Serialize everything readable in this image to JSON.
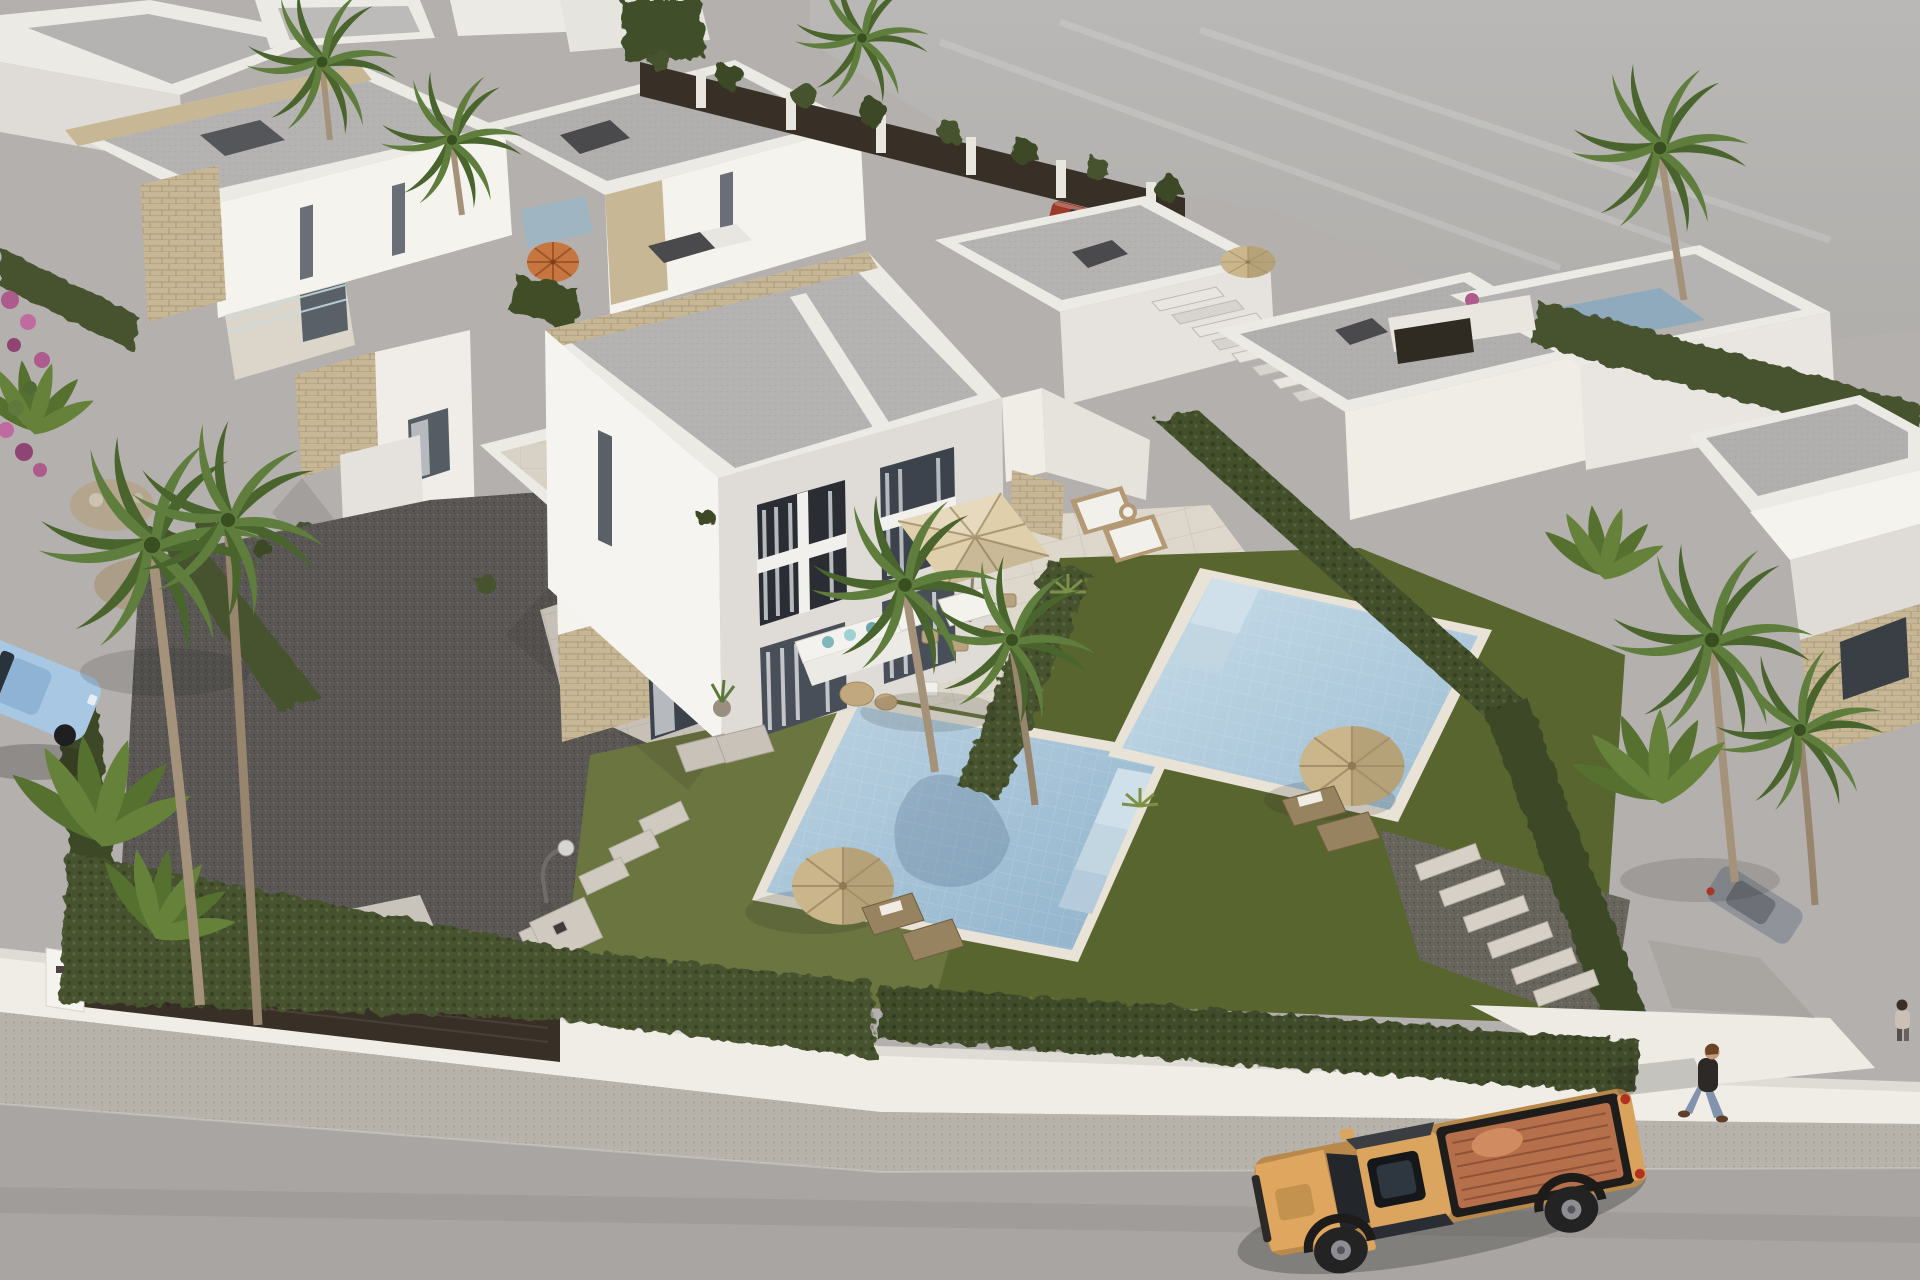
{
  "meta": {
    "kind": "photorealistic 3D architectural visualization",
    "view": "aerial oblique, sunlight from upper right",
    "width_px": 1920,
    "height_px": 1280
  },
  "scene": {
    "description": "Aerial render of a modern residential development: a central semi-detached two-storey white villa with stone-clad accents, two private pools with lawns, gravel yard, straw and beige parasols, loungers, palm trees and clipped hedges behind a white perimeter wall; an asphalt street with an orange pickup truck and a pedestrian runs along the bottom; background rows of flat-roof villas and an empty graded plot at upper right.",
    "objects": [
      "semi-detached two-storey villa (center)",
      "background white villas with flat roofs",
      "external roof stairs on background villas",
      "rooftop chimney boxes",
      "stone-clad facade accents",
      "glass balustrades",
      "two private swimming pools with underwater steps",
      "travertine pool terraces",
      "lawns and dark gravel yard",
      "clipped cypress hedges",
      "white perimeter wall with dark driveway gate",
      "stepping-stone paths",
      "thatched straw parasols",
      "square beige patio parasol with dining set",
      "white lounge sofa with teal cushions",
      "rattan and wooden sun loungers",
      "street lamp",
      "palm trees, banana plants, magenta bougainvillea",
      "empty graded plot (upper right)",
      "asphalt street with gravel verge",
      "orange pickup truck with open bed",
      "light-blue parked car (left edge)",
      "red parked car (background)",
      "gray parked car (right driveway)",
      "pedestrian in dark shirt and jeans",
      "second pedestrian at right edge"
    ]
  },
  "palette": {
    "ground": "#b3b0ad",
    "land": "#b8b6b3",
    "street": "#a8a5a2",
    "sidewalk": "#b7b3ab",
    "wall": "#f0ede7",
    "villaLit": "#f5f3ee",
    "villaShade": "#dfdcd7",
    "roofDeck": "#b5b3b2",
    "parapet": "#eceae5",
    "stone": "#c8b795",
    "hedge": "#46522e",
    "grass": "#6a7540",
    "grassShade": "#59652f",
    "pool": "#a9c6da",
    "poolDeep": "#8fb2cb",
    "coping": "#e9e3d7",
    "gravel": "#5a5754",
    "paving": "#ddd7cc",
    "terracotta": "#c8763f",
    "straw": "#cbb68c",
    "beige": "#dfcfab",
    "truck": "#dfa660",
    "truckBed": "#b56f4a",
    "carBlue": "#a7c7e2",
    "carRed": "#9c3a2a",
    "carGray": "#90949a",
    "palm": "#5f7d3c",
    "palmDark": "#4a642e",
    "trunk": "#a4937a",
    "gate": "#383026",
    "glass": "#2a2e34",
    "curtain": "#b6b9bd",
    "skin": "#c9997a",
    "shirt": "#2c2927",
    "jeans": "#8393ad"
  }
}
